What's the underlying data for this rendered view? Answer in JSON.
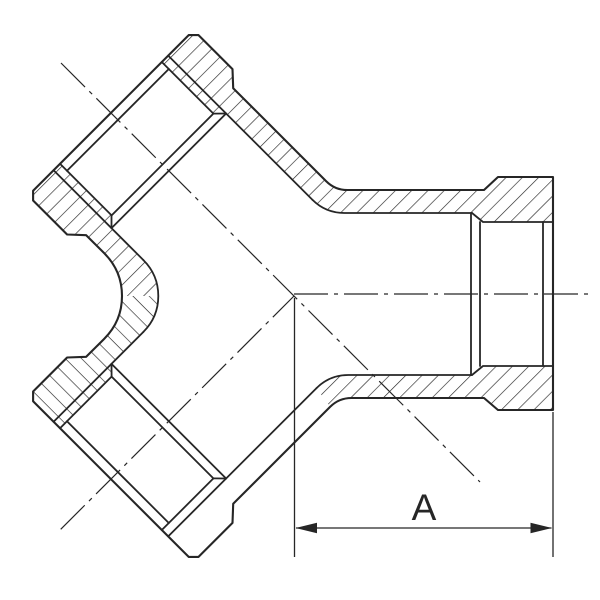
{
  "drawing": {
    "ink_color": "#262626",
    "background_color": "#ffffff",
    "canvas": {
      "width": 600,
      "height": 600
    },
    "dimension": {
      "label": "A"
    },
    "hatch_spacing": 11.5,
    "paths": [
      {
        "name": "hatch-top-wall",
        "type": "hatch-fwd",
        "d": "M161.8 62 L188.7 35.1 L198.5 35.1 L232.5 69.1 L233.2 88.2 L326.2 181.2 Q335 190 347.4 190 L484 190 L498 177 L553 177 L553 222 L483 222 L472 213 L344.2 213 Q325.6 213 312.4 199.8 L226.1 113.5 L213.4 113.6 Z"
      },
      {
        "name": "hatch-bottom-wall",
        "type": "hatch-fwd",
        "d": "M330.2 406.8 Q339 398 351.4 398 L484 398 L498 410 L553 410 L553 366 L483 366 L472 375 L348.2 375 Q329.6 375 316.4 388.2 Z"
      },
      {
        "name": "hatch-crotch-upper",
        "type": "hatch-fwd",
        "d": "M60 163.8 L111.6 215.4 L111.5 228.1 L143.3 260 Q158.3 274.9 158.3 296 L122 296 Q122 271 104.3 253.3 L86.2 235.2 L67.1 234.5 L33.1 200.5 L33.1 190.7 L53.6 170.2 Z"
      },
      {
        "name": "hatch-crotch-lower",
        "type": "hatch-back",
        "d": "M158.3 296 Q158.3 317.1 143.3 332 L111.5 363.9 L111.6 376.6 L60 428.2 L33.1 401.3 L33.1 391.5 L67.1 357.5 L86.2 356.8 L104.3 338.7 Q122 321 122 296 Z"
      },
      {
        "name": "outer-silhouette",
        "type": "outline",
        "d": "M33.1 190.7 L188.7 35.1 L198.5 35.1 L232.5 69.1 L233.2 88.2 L326.2 181.2 Q335 190 347.4 190 L484 190 L498 177 L553 177 L553 410 L498 410 L484 398 L351.4 398 Q339 398 330.2 406.8 L233.2 503.8 L232.5 522.9 L198.5 556.9 L188.7 556.9 L33.1 401.3 L33.1 391.5 L67.1 357.5 L86.2 356.8 L104.3 338.7 Q122 321 122 296 Q122 271 104.3 253.3 L86.2 235.2 L67.1 234.5 L33.1 200.5 Z"
      },
      {
        "name": "thread-line-upper-crotch-side",
        "type": "inner",
        "d": "M60 163.8 L111.6 215.4"
      },
      {
        "name": "shoulder-chamfer-upper-crotch",
        "type": "inner",
        "d": "M111.5 215.4 L111.5 228.1"
      },
      {
        "name": "bore-line-upper-crotch-side",
        "type": "inner",
        "d": "M53.6 170.2 L143.3 260"
      },
      {
        "name": "crotch-bore-fillet-arc",
        "type": "inner",
        "d": "M143.3 260 Q158.3 274.9 158.3 296 Q158.3 317.1 143.3 332"
      },
      {
        "name": "bore-line-lower-crotch-side",
        "type": "inner",
        "d": "M143.3 332 L53.6 421.8"
      },
      {
        "name": "shoulder-chamfer-lower-crotch",
        "type": "inner",
        "d": "M111.5 363.9 L111.6 376.6"
      },
      {
        "name": "thread-line-lower-crotch-side",
        "type": "inner",
        "d": "M111.6 376.6 L60 428.2"
      },
      {
        "name": "thread-line-upper-outer-side",
        "type": "inner",
        "d": "M161.8 62 L213.4 113.6"
      },
      {
        "name": "shoulder-chamfer-upper-outer",
        "type": "inner",
        "d": "M213.4 113.6 L226.1 113.5"
      },
      {
        "name": "bore-line-upper-outer-side",
        "type": "inner",
        "d": "M168.2 55.6 L312.4 199.8"
      },
      {
        "name": "waterway-top-inner",
        "type": "inner",
        "d": "M312.4 199.8 Q325.6 213 344.2 213 L472 213"
      },
      {
        "name": "socket-chamfer-top-right",
        "type": "inner",
        "d": "M472 213 L483 222 L553 222"
      },
      {
        "name": "shoulder-line-upper-1",
        "type": "inner",
        "d": "M111.5 228.1 L226.1 113.5"
      },
      {
        "name": "shoulder-line-upper-2",
        "type": "inner",
        "d": "M111.6 215.4 L213.4 113.6"
      },
      {
        "name": "mouth-chamfer-upper",
        "type": "inner",
        "d": "M67 170.8 L168.8 69"
      },
      {
        "name": "socket-shoulder-right-1",
        "type": "inner",
        "d": "M471 213 L471 375"
      },
      {
        "name": "socket-shoulder-right-2",
        "type": "inner",
        "d": "M480 222 L480 366"
      },
      {
        "name": "socket-mouth-chamfer-right",
        "type": "inner",
        "d": "M543 222 L543 366"
      },
      {
        "name": "waterway-bottom-inner",
        "type": "inner",
        "d": "M316.4 388.2 Q329.6 375 348.2 375 L472 375"
      },
      {
        "name": "socket-chamfer-bottom-right",
        "type": "inner",
        "d": "M472 375 L483 366 L553 366"
      },
      {
        "name": "bore-line-lower-outer-side",
        "type": "inner",
        "d": "M316.4 388.2 L168.2 536.4"
      },
      {
        "name": "shoulder-line-lower-1",
        "type": "inner",
        "d": "M111.5 363.9 L226.1 478.5"
      },
      {
        "name": "shoulder-line-lower-2",
        "type": "inner",
        "d": "M111.6 376.6 L213.4 478.4"
      },
      {
        "name": "shoulder-chamfer-lower-outer",
        "type": "inner",
        "d": "M226.1 478.5 L213.4 478.4"
      },
      {
        "name": "thread-line-lower-outer-side",
        "type": "inner",
        "d": "M213.4 478.4 L161.8 530"
      },
      {
        "name": "mouth-chamfer-lower",
        "type": "inner",
        "d": "M67 421.2 L168.8 523"
      },
      {
        "name": "centerline-horizontal",
        "type": "center",
        "d": "M294 294 L592 294"
      },
      {
        "name": "centerline-upper-branch",
        "type": "center",
        "d": "M61 63 L480 482"
      },
      {
        "name": "centerline-lower-branch",
        "type": "center",
        "d": "M60.7 529.3 L294 296"
      },
      {
        "name": "extension-line-left",
        "type": "dim",
        "d": "M294.5 298 L294.5 557"
      },
      {
        "name": "extension-line-right",
        "type": "dim",
        "d": "M553 412 L553 557"
      },
      {
        "name": "dimension-line",
        "type": "dim",
        "d": "M296 528 L551.5 528"
      },
      {
        "name": "dimension-arrow-left",
        "type": "arrow",
        "d": "M295.5 528 L317 522.8 L317 533.2 Z"
      },
      {
        "name": "dimension-arrow-right",
        "type": "arrow",
        "d": "M552 528 L530.5 522.8 L530.5 533.2 Z"
      }
    ]
  }
}
